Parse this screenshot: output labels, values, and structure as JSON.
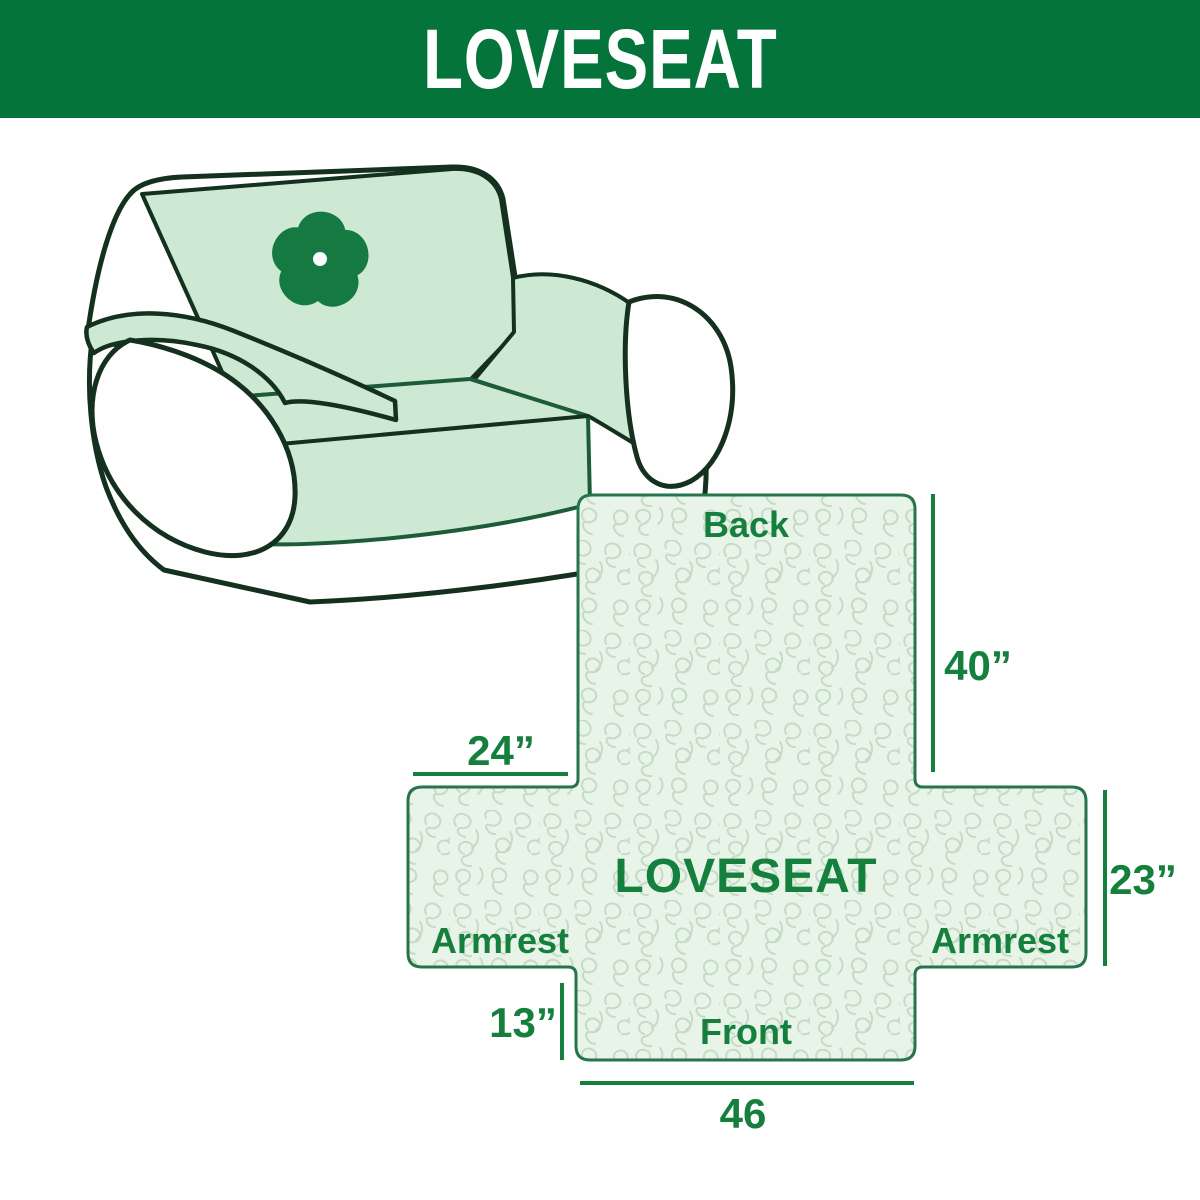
{
  "banner": {
    "title": "LOVESEAT",
    "background_color": "#04743a",
    "text_color": "#ffffff"
  },
  "sofa_illustration": {
    "description": "line-art loveseat sofa with mint slipcover",
    "logo_icon": "pinwheel-flower-icon",
    "cover_color": "#cde9d3",
    "outline_color": "#14301f",
    "logo_color": "#157a42"
  },
  "diagram": {
    "center_label": "LOVESEAT",
    "back_label": "Back",
    "front_label": "Front",
    "armrest_left_label": "Armrest",
    "armrest_right_label": "Armrest",
    "dim_back_height": "40”",
    "dim_armrest_width": "24”",
    "dim_armrest_height": "23”",
    "dim_front_depth": "13”",
    "dim_front_width": "46",
    "fill_color": "#e9f4e9",
    "pattern_line_color": "#c6dbc7",
    "outline_color": "#25744a",
    "label_color": "#15803d"
  }
}
